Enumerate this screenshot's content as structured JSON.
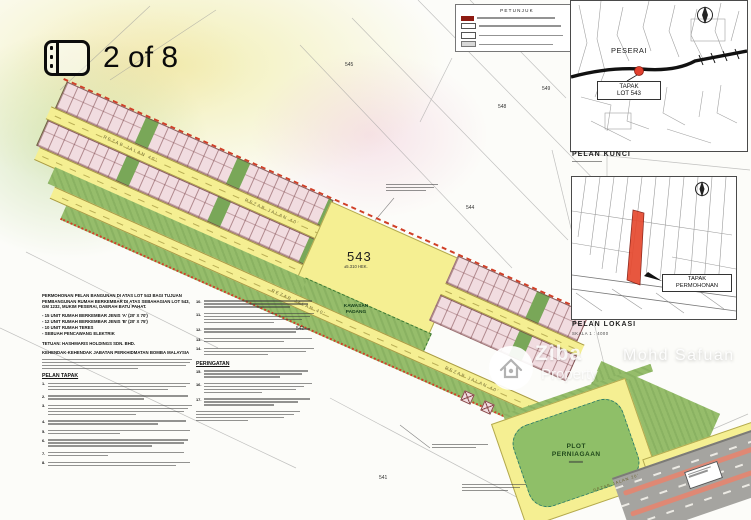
{
  "viewer": {
    "counter": "2 of 8",
    "watermark": {
      "brand_top": "Ziba",
      "brand_bottom": "Property",
      "agent": "Mohd Safuan"
    }
  },
  "plan": {
    "legend_title": "PETUNJUK",
    "title_block": {
      "intro": "PERMOHONAN PELAN BANGUNAN DI ATAS LOT 543 BAGI TUJUAN PEMBANGUNAN RUMAH BERKEMBAR DI ATAS SEBAHAGIAN LOT 543, GM 1232, MUKIM PESERAI, DAERAH BATU PAHAT.",
      "bullets": [
        "- 15 UNIT RUMAH BERKEMBAR JENIS 'A' (20' X 70')",
        "- 12 UNIT RUMAH BERKEMBAR JENIS 'B' (20' X 75')",
        "- 10 UNIT RUMAH TERES",
        "- SEBUAH PENCAWANG ELEKTRIK"
      ],
      "tetuan": "TETUAN: HASHMARIS HOLDINGS SDN. BHD.",
      "bomba": "KEHENDAK-KEHENDAK JABATAN PERKHIDMATAN BOMBA MALAYSIA",
      "site_plan_heading": "PELAN TAPAK",
      "reminder_heading": "PERINGATAN",
      "note_numbers_left": [
        "1.",
        "2.",
        "3.",
        "4.",
        "5.",
        "6.",
        "7.",
        "8."
      ],
      "note_numbers_right": [
        "10.",
        "11.",
        "12.",
        "13.",
        "14.",
        "15.",
        "16.",
        "17."
      ]
    },
    "site": {
      "lot_number": "543",
      "lot_area": "±5.310 HEK.",
      "field_label_1": "KAWASAN",
      "field_label_2": "PADANG",
      "plot_label_1": "PLOT",
      "plot_label_2": "PERNIAGAAN",
      "road_label_main": "REZAB JALAN 40'",
      "road_label_small": "REZAB JALAN 20'",
      "neighbour_lots": [
        "545",
        "549",
        "548",
        "544",
        "542",
        "541"
      ]
    },
    "inset_key": {
      "caption": "PELAN KUNCI",
      "town": "PESERAI",
      "tag_line1": "TAPAK",
      "tag_line2": "LOT 543"
    },
    "inset_location": {
      "caption": "PELAN LOKASI",
      "scale": "SKALA 1 : 4000",
      "tag_line1": "TAPAK",
      "tag_line2": "PERMOHONAN"
    }
  }
}
